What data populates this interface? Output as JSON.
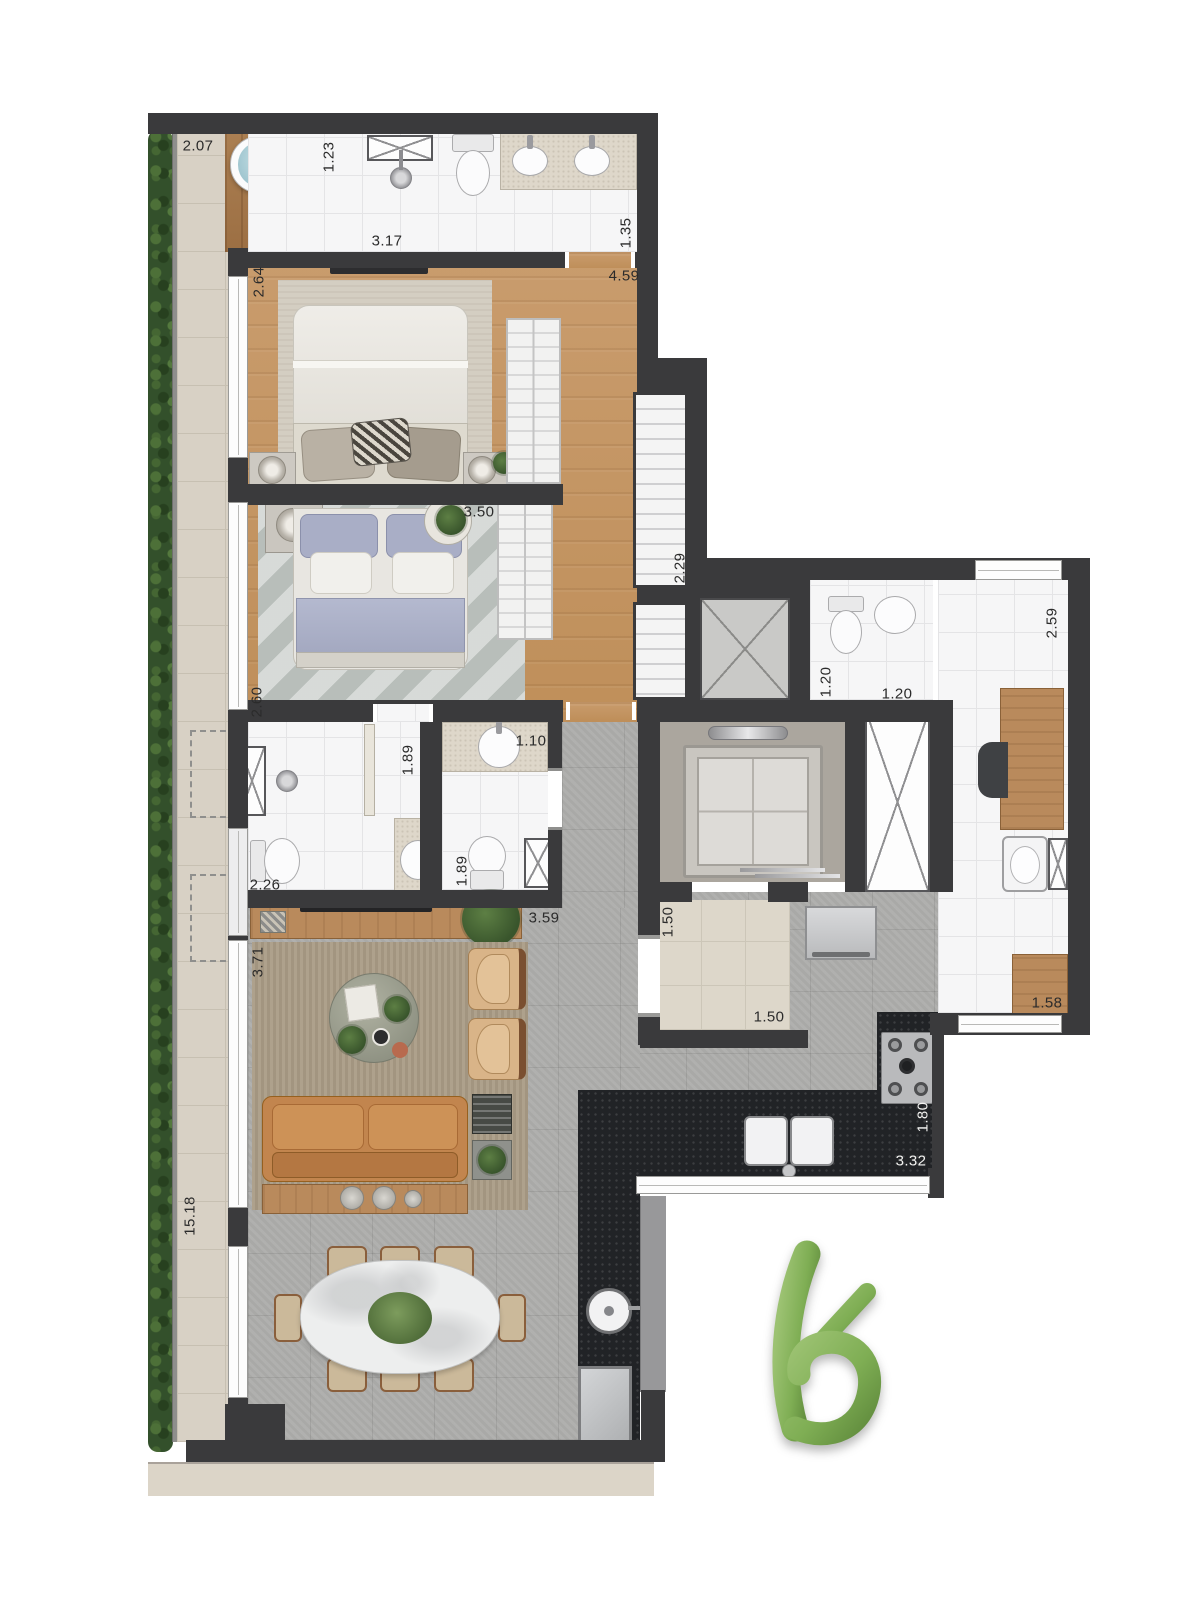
{
  "dimension_labels": [
    {
      "text": "2.07",
      "x": 198,
      "y": 146,
      "vertical": false
    },
    {
      "text": "1.23",
      "x": 329,
      "y": 157,
      "vertical": true
    },
    {
      "text": "3.17",
      "x": 387,
      "y": 241,
      "vertical": false
    },
    {
      "text": "1.35",
      "x": 626,
      "y": 233,
      "vertical": true
    },
    {
      "text": "4.59",
      "x": 624,
      "y": 276,
      "vertical": false
    },
    {
      "text": "2.64",
      "x": 259,
      "y": 282,
      "vertical": true
    },
    {
      "text": "3.50",
      "x": 479,
      "y": 512,
      "vertical": false
    },
    {
      "text": "2.29",
      "x": 680,
      "y": 568,
      "vertical": true
    },
    {
      "text": "2.60",
      "x": 257,
      "y": 702,
      "vertical": true
    },
    {
      "text": "2.59",
      "x": 1052,
      "y": 623,
      "vertical": true
    },
    {
      "text": "1.20",
      "x": 826,
      "y": 682,
      "vertical": true
    },
    {
      "text": "1.20",
      "x": 897,
      "y": 694,
      "vertical": false
    },
    {
      "text": "1.89",
      "x": 408,
      "y": 760,
      "vertical": true
    },
    {
      "text": "1.10",
      "x": 531,
      "y": 741,
      "vertical": false
    },
    {
      "text": "2.26",
      "x": 265,
      "y": 885,
      "vertical": false
    },
    {
      "text": "1.89",
      "x": 462,
      "y": 871,
      "vertical": true
    },
    {
      "text": "3.59",
      "x": 544,
      "y": 918,
      "vertical": false
    },
    {
      "text": "1.50",
      "x": 668,
      "y": 922,
      "vertical": true
    },
    {
      "text": "1.50",
      "x": 769,
      "y": 1017,
      "vertical": false
    },
    {
      "text": "1.58",
      "x": 1047,
      "y": 1003,
      "vertical": false
    },
    {
      "text": "3.71",
      "x": 258,
      "y": 962,
      "vertical": true
    },
    {
      "text": "1.80",
      "x": 923,
      "y": 1117,
      "vertical": true,
      "light": true
    },
    {
      "text": "3.32",
      "x": 911,
      "y": 1161,
      "vertical": false,
      "light": true
    },
    {
      "text": "15.18",
      "x": 190,
      "y": 1216,
      "vertical": true
    }
  ],
  "logo": {
    "shape": "stylized-b",
    "color_light": "#9cc272",
    "color_mid": "#7fae54",
    "color_dark": "#5f8a3c"
  },
  "palette": {
    "wall": "#3a3a3c",
    "wood_floor": "#c4945f",
    "deck_wood": "#a87c4f",
    "white_tile": "#f6f6f7",
    "beige_tile": "#d8d1c5",
    "grey_tile": "#aeaeac",
    "black_counter": "#212326",
    "hedge_green": "#33502b",
    "sofa_tan": "#c2854e",
    "water_blue": "#9cc3cd"
  }
}
